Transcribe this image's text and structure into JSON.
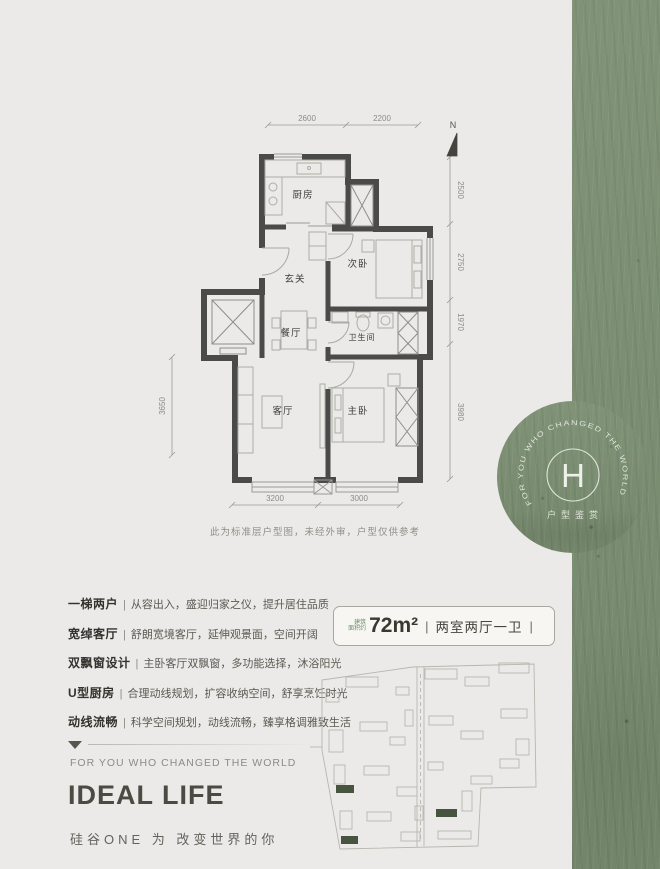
{
  "colors": {
    "green": "#7b8f72",
    "wall": "#4a4a48",
    "ink": "#33332d"
  },
  "floorplan": {
    "north": "N",
    "caption": "此为标准层户型图，未经外审，户型仅供参考",
    "rooms": {
      "kitchen": "厨房",
      "entry": "玄关",
      "bedroom2": "次卧",
      "dining": "餐厅",
      "bath": "卫生间",
      "living": "客厅",
      "master": "主卧"
    },
    "dims": {
      "top": [
        "2600",
        "2200"
      ],
      "right": [
        "2500",
        "2750",
        "1970",
        "3980"
      ],
      "left": [
        "3650"
      ],
      "bottom": [
        "3200",
        "3000"
      ]
    }
  },
  "badge": {
    "prefix1": "建筑",
    "prefix2": "面积约",
    "area": "72m²",
    "layout": "两室两厅一卫"
  },
  "misc": {
    "pipe": "|"
  },
  "features": [
    {
      "term": "一梯两户",
      "desc": "从容出入，盛迎归家之仪，提升居住品质"
    },
    {
      "term": "宽绰客厅",
      "desc": "舒朗宽境客厅，延伸观景面，空间开阔"
    },
    {
      "term": "双飘窗设计",
      "desc": "主卧客厅双飘窗，多功能选择，沐浴阳光"
    },
    {
      "term": "U型厨房",
      "desc": "合理动线规划，扩容收纳空间，舒享烹饪时光"
    },
    {
      "term": "动线流畅",
      "desc": "科学空间规划，动线流畅，臻享格调雅致生活"
    }
  ],
  "side": {
    "curved_text": "FOR YOU WHO CHANGED THE WORLD",
    "letter": "H",
    "label": "户型鉴赏"
  },
  "footer": {
    "slogan_en": "FOR YOU WHO CHANGED THE WORLD",
    "title": "IDEAL LIFE",
    "slogan_cn": "硅谷ONE 为 改变世界的你"
  }
}
